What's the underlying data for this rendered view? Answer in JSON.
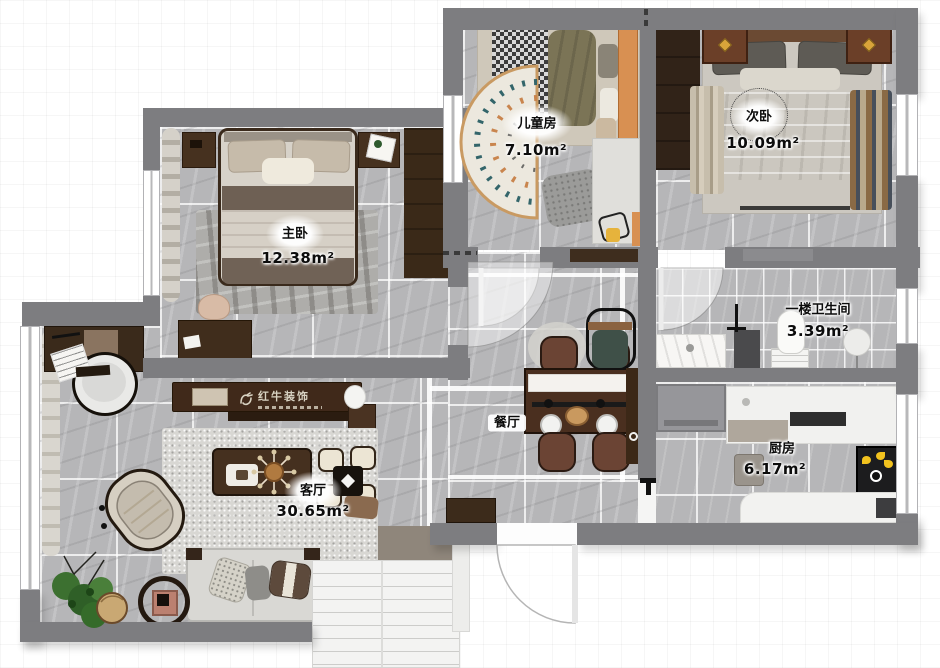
{
  "brand": {
    "name": "红牛装饰"
  },
  "rooms": [
    {
      "id": "master-bedroom",
      "name": "主卧",
      "area": "12.38m²"
    },
    {
      "id": "children-room",
      "name": "儿童房",
      "area": "7.10m²"
    },
    {
      "id": "second-bedroom",
      "name": "次卧",
      "area": "10.09m²"
    },
    {
      "id": "bathroom",
      "name": "一楼卫生间",
      "area": "3.39m²"
    },
    {
      "id": "kitchen",
      "name": "厨房",
      "area": "6.17m²"
    },
    {
      "id": "dining-room",
      "name": "餐厅",
      "area": ""
    },
    {
      "id": "living-room",
      "name": "客厅",
      "area": "30.65m²"
    }
  ],
  "colors": {
    "wall": "#7d7d80",
    "floor": "#b6b6b8",
    "dark_wood": "#3c2b1d",
    "orange_accent": "#d89052",
    "teal_accent": "#33656a"
  }
}
